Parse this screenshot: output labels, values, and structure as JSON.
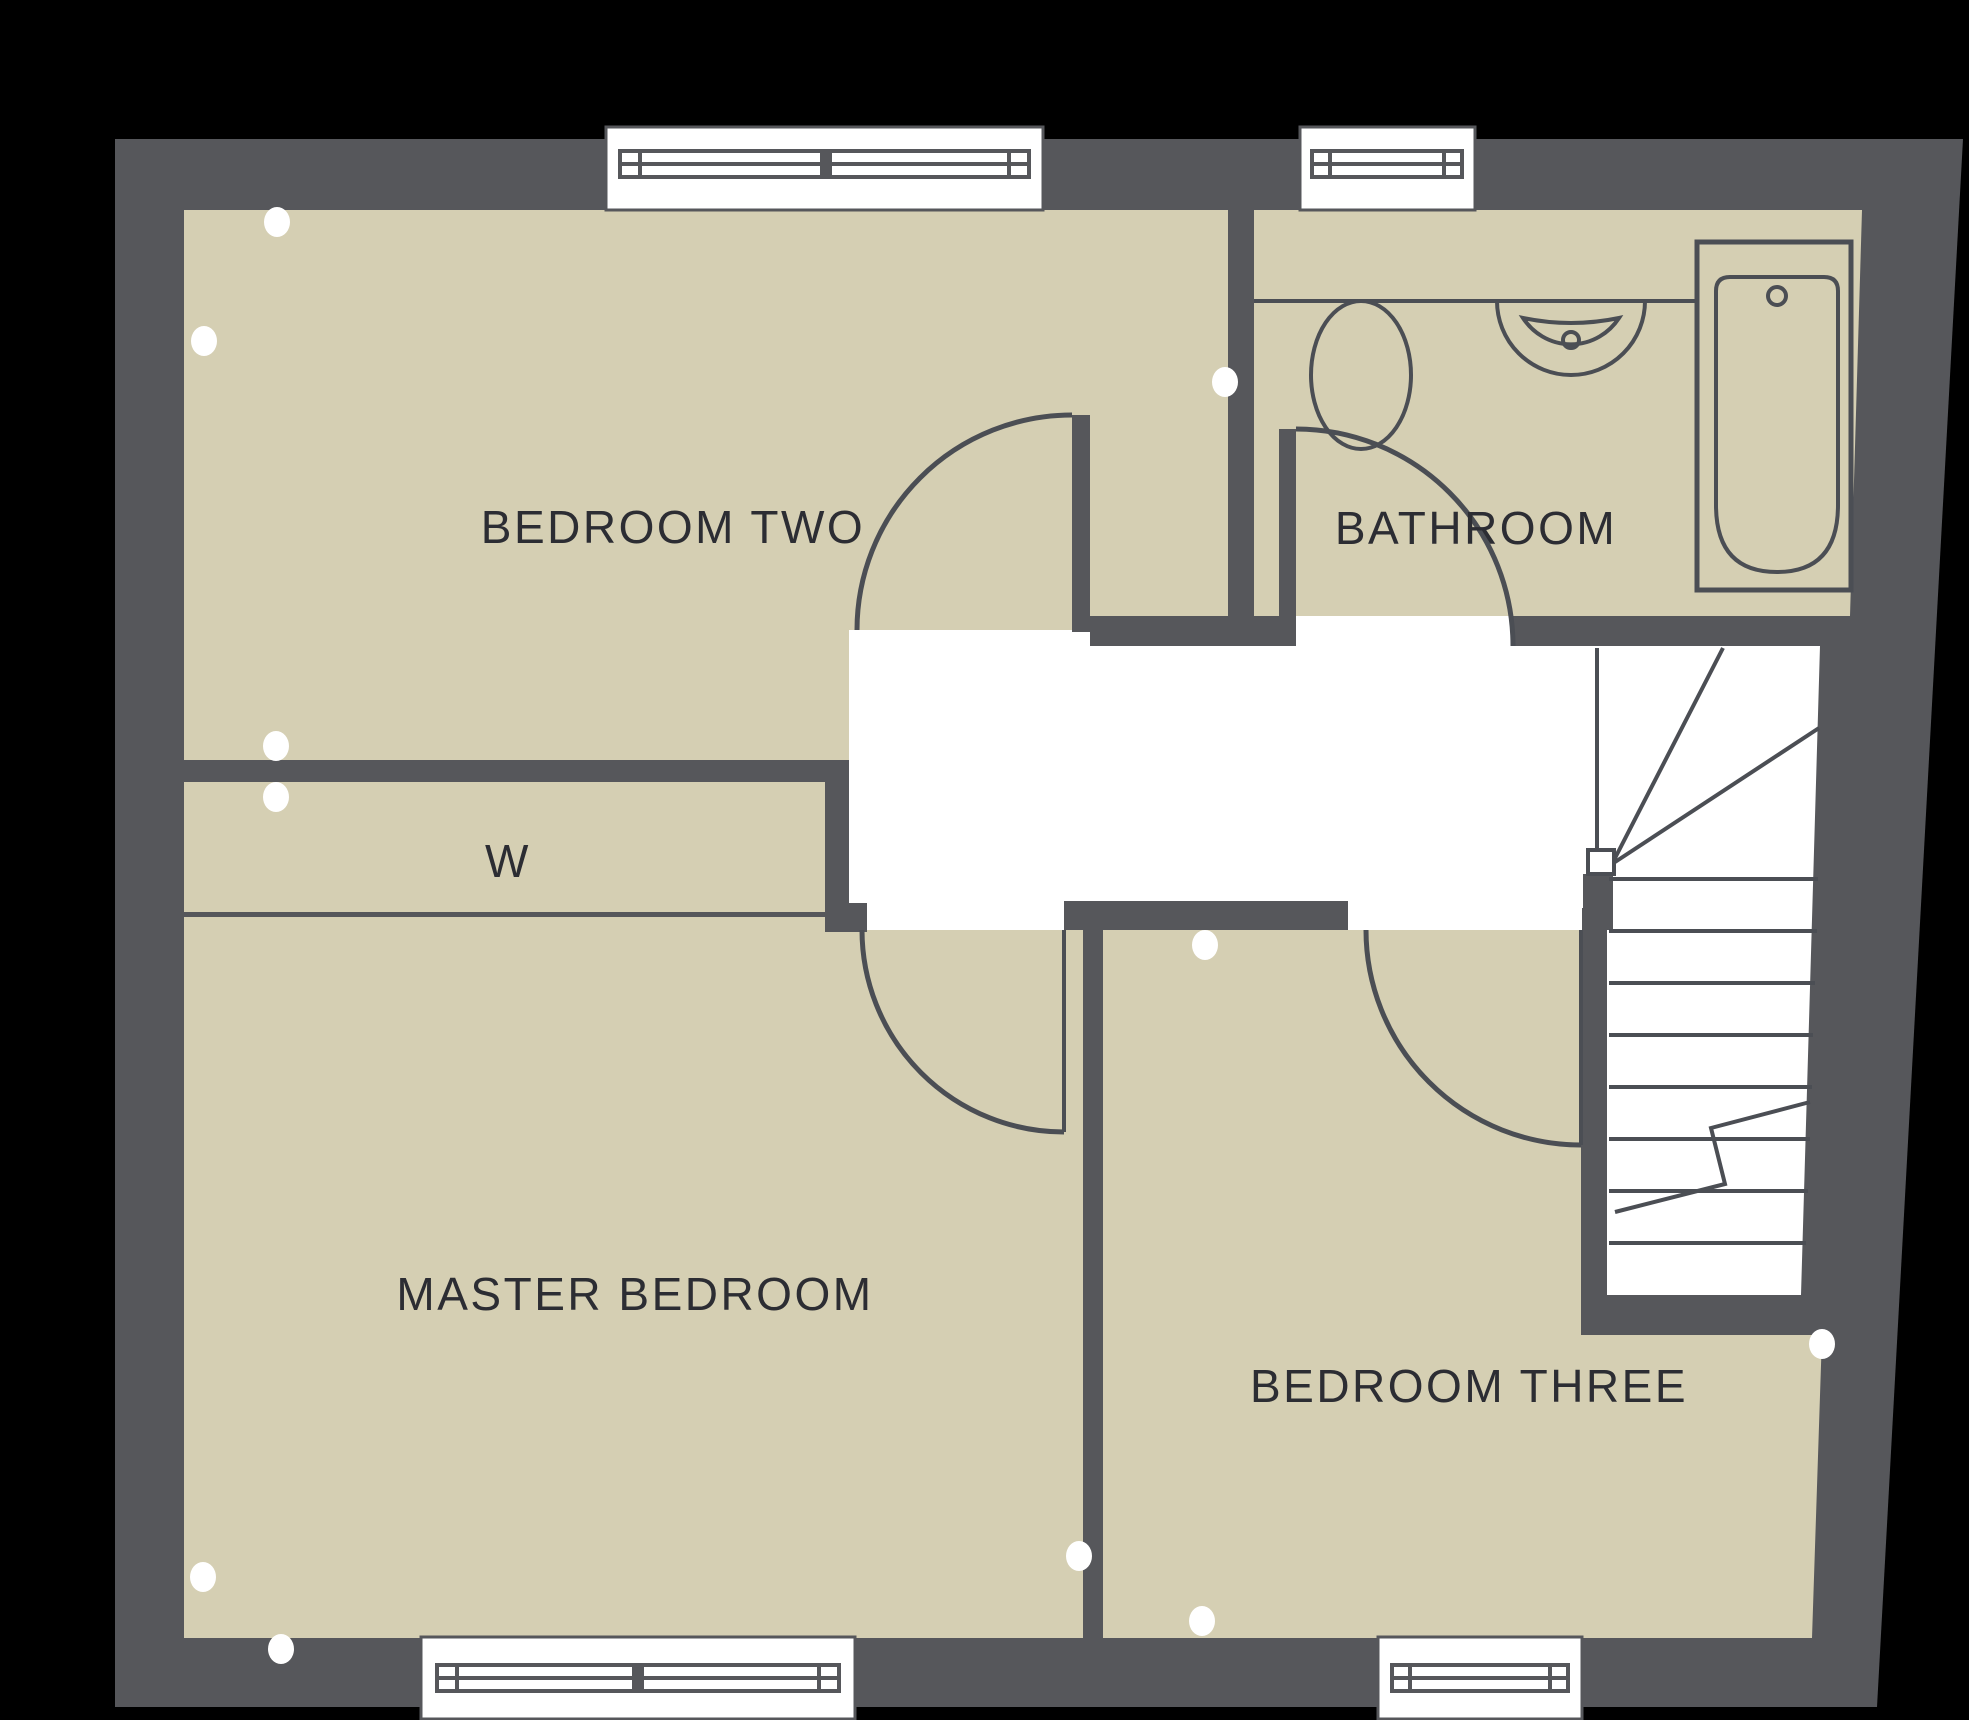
{
  "plan": {
    "type": "first-floor-plan",
    "rooms": [
      {
        "id": "bedroom-two",
        "label": "BEDROOM TWO"
      },
      {
        "id": "bathroom",
        "label": "BATHROOM"
      },
      {
        "id": "wardrobe",
        "label": "W"
      },
      {
        "id": "master-bedroom",
        "label": "MASTER BEDROOM"
      },
      {
        "id": "bedroom-three",
        "label": "BEDROOM THREE"
      }
    ],
    "fixtures": [
      "toilet",
      "wash-basin",
      "bath",
      "winder-staircase"
    ],
    "features": [
      "four-windows",
      "five-door-swings",
      "wall-marker-dots",
      "stair-break-line"
    ],
    "colors": {
      "background": "#000000",
      "wall": "#56575b",
      "floor": "#d5cfb3",
      "hallway": "#ffffff",
      "line": "#4b4e54",
      "text": "#2c2d33"
    }
  }
}
